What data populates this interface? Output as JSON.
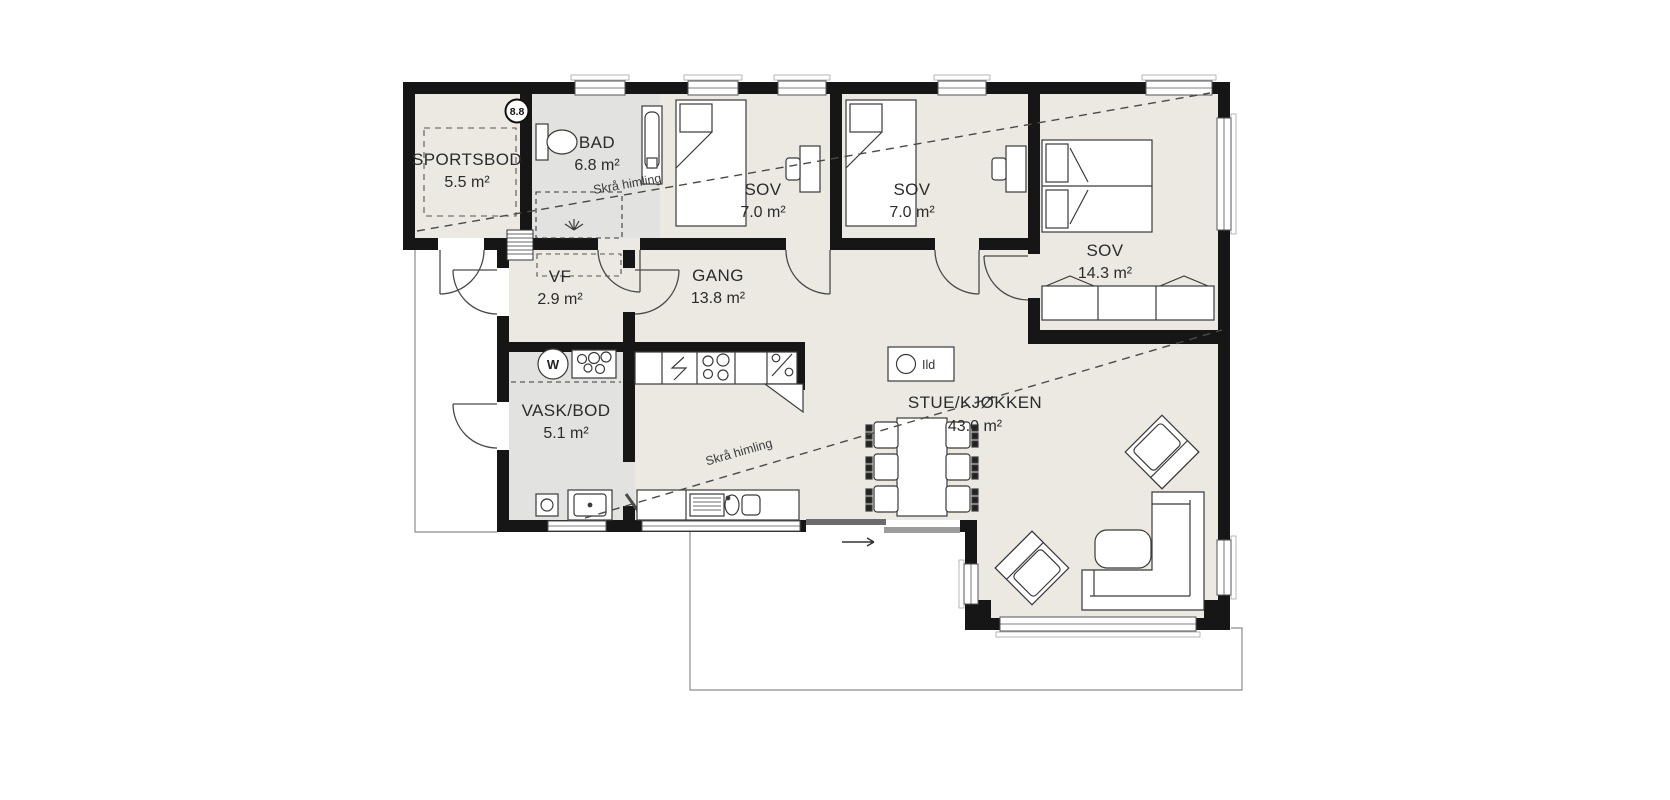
{
  "plan": {
    "rooms": [
      {
        "key": "sportsbod",
        "name": "SPORTSBOD",
        "area": "5.5 m²"
      },
      {
        "key": "bad",
        "name": "BAD",
        "area": "6.8 m²"
      },
      {
        "key": "sov1",
        "name": "SOV",
        "area": "7.0 m²"
      },
      {
        "key": "sov2",
        "name": "SOV",
        "area": "7.0 m²"
      },
      {
        "key": "sov3",
        "name": "SOV",
        "area": "14.3 m²"
      },
      {
        "key": "vf",
        "name": "VF",
        "area": "2.9 m²"
      },
      {
        "key": "gang",
        "name": "GANG",
        "area": "13.8 m²"
      },
      {
        "key": "vask_bod",
        "name": "VASK/BOD",
        "area": "5.1 m²"
      },
      {
        "key": "stue_kjokken",
        "name": "STUE/KJØKKEN",
        "area": "43.0 m²"
      }
    ],
    "annotations": {
      "sloped_ceiling_1": "Skrå himling",
      "sloped_ceiling_2": "Skrå himling",
      "fireplace_label": "Ild",
      "ceiling_height_badge": "8.8",
      "washer_letter": "W"
    },
    "colors": {
      "wall": "#161616",
      "floor": "#ebe9e2",
      "wet_room_floor": "#e2e2e0",
      "furniture_line": "#3a3a3a",
      "outline": "#8c8c8c",
      "background": "#ffffff"
    }
  }
}
